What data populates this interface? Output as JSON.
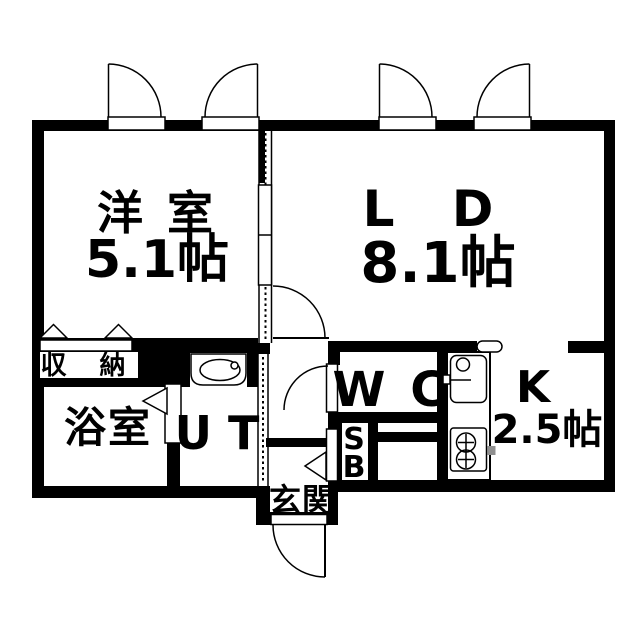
{
  "plan": {
    "rooms": {
      "western": {
        "label": "洋 室",
        "size": "5.1帖"
      },
      "living_dining": {
        "label": "L D",
        "size": "8.1帖"
      },
      "kitchen": {
        "label": "K",
        "size": "2.5帖"
      },
      "bath": {
        "label": "浴室"
      },
      "utility": {
        "label": "U T"
      },
      "toilet": {
        "label": "W C"
      },
      "entrance": {
        "label": "玄関"
      },
      "storage": {
        "label": "収 納"
      },
      "shoe_box": {
        "line1": "S",
        "line2": "B"
      }
    },
    "icons": {
      "washbasin": "oval-basin-with-tap",
      "kitchen_sink": "sink-with-faucet",
      "stove": "two-burner-stove",
      "door": "quarter-circle-swing-arc",
      "window": "casement-window-arc",
      "folding_door": "triangle-fold-symbol",
      "sliding_door": "panel-with-arrow-symbol"
    },
    "colors": {
      "wall": "#000000",
      "background": "#ffffff",
      "stove_handle": "#8f8f8f"
    }
  }
}
